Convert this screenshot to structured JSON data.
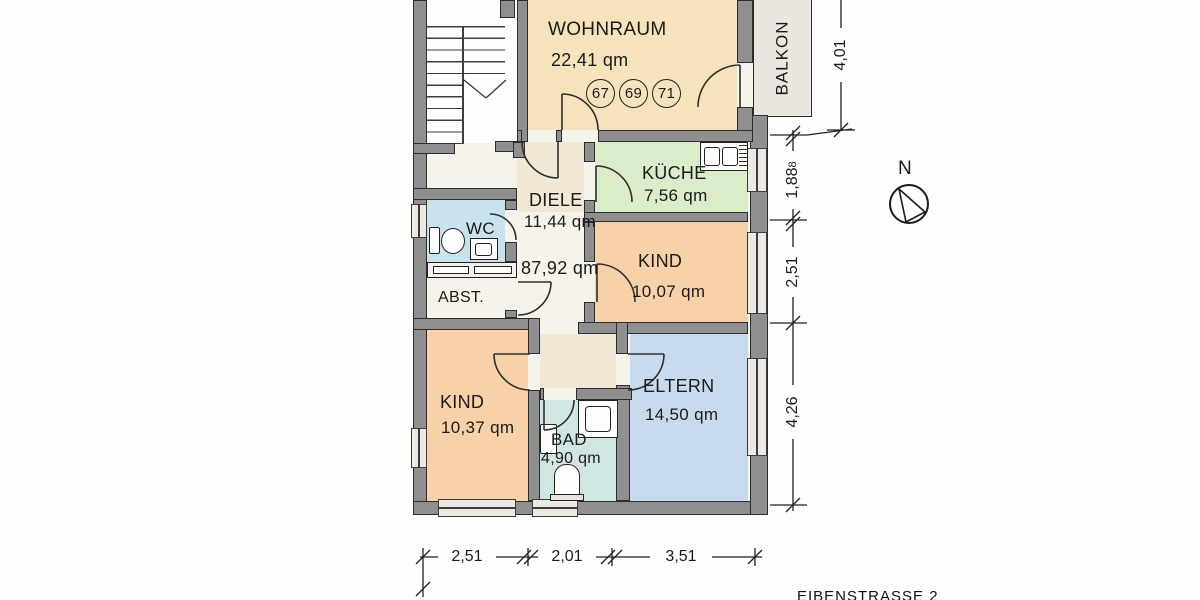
{
  "floorplan": {
    "rooms": {
      "wohnraum": {
        "name": "WOHNRAUM",
        "area": "22,41 qm"
      },
      "kueche": {
        "name": "KÜCHE",
        "area": "7,56 qm"
      },
      "diele": {
        "name": "DIELE",
        "area": "11,44 qm"
      },
      "wc": {
        "name": "WC"
      },
      "abst": {
        "name": "ABST."
      },
      "kind_top": {
        "name": "KIND",
        "area": "10,07 qm"
      },
      "kind_bottom": {
        "name": "KIND",
        "area": "10,37 qm"
      },
      "eltern": {
        "name": "ELTERN",
        "area": "14,50 qm"
      },
      "bad": {
        "name": "BAD",
        "area": "4,90 qm"
      },
      "balkon": {
        "name": "BALKON"
      }
    },
    "total_area": "87,92 qm",
    "unit_numbers": [
      "67",
      "69",
      "71"
    ],
    "compass": {
      "north_label": "N"
    },
    "street_label": "EIBENSTRASSE 2",
    "dimensions": {
      "right": [
        {
          "value": "4,01",
          "sup": ""
        },
        {
          "value": "1,88",
          "sup": "8"
        },
        {
          "value": "2,51",
          "sup": ""
        },
        {
          "value": "4,26",
          "sup": ""
        }
      ],
      "bottom": [
        "2,51",
        "2,01",
        "3,51"
      ]
    },
    "colors": {
      "room_beige": "#f6e3bb",
      "room_green": "#dbeccb",
      "room_orange": "#f7d1a8",
      "room_blue": "#c8daee",
      "room_cyan": "#d0e6e2",
      "room_lightblue": "#c8e3eb",
      "balcony_gray": "#e9e7e0",
      "wall_gray": "#8f8f8f"
    }
  }
}
